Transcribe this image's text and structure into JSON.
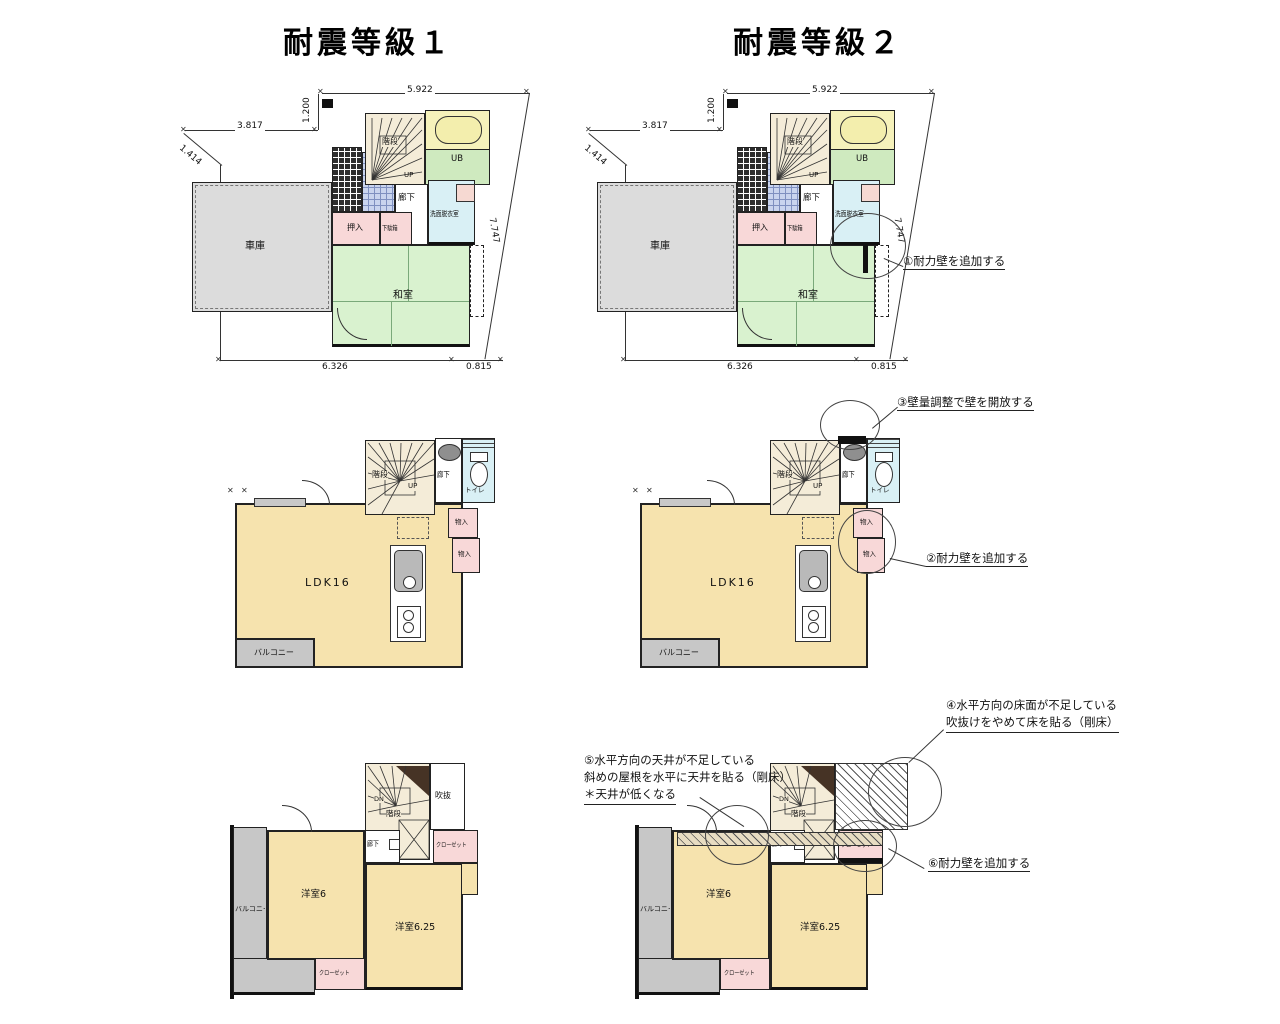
{
  "titles": {
    "grade1": "耐震等級１",
    "grade2": "耐震等級２"
  },
  "dimensions": {
    "top_width": "5.922",
    "entry_offset": "1.200",
    "left_top": "3.817",
    "diag_left": "1.414",
    "left_height": "5.364",
    "bottom_main": "6.326",
    "bottom_right": "0.815",
    "diag_right": "7.747"
  },
  "floor1": {
    "garage": "車庫",
    "oshiire": "押入",
    "getabako": "下駄箱",
    "stairs": "階段",
    "up": "UP",
    "hallway": "廊下",
    "washroom": "洗面脱衣室",
    "bath": "UB",
    "tatami": "和室"
  },
  "floor2": {
    "stairs": "階段",
    "up": "UP",
    "hallway": "廊下",
    "toilet": "トイレ",
    "storage_a": "物入",
    "storage_b": "物入",
    "ldk": "LDK16",
    "balcony": "バルコニー"
  },
  "floor3": {
    "stairs": "階段",
    "dn": "DN",
    "hallway": "廊下",
    "void": "吹抜",
    "closet_a": "クローゼット",
    "closet_b": "クローゼット",
    "bedroom_a": "洋室6",
    "bedroom_b": "洋室6.25",
    "balcony": "バルコニー"
  },
  "annotations": {
    "a1": "①耐力壁を追加する",
    "a2": "②耐力壁を追加する",
    "a3": "③壁量調整で壁を開放する",
    "a4_line1": "④水平方向の床面が不足している",
    "a4_line2": "吹抜けをやめて床を貼る（剛床）",
    "a5_line1": "⑤水平方向の天井が不足している",
    "a5_line2": "斜めの屋根を水平に天井を貼る（剛床）",
    "a5_line3": "＊天井が低くなる",
    "a6": "⑥耐力壁を追加する"
  },
  "colors": {
    "room_cream": "#f6e3ae",
    "tatami_green": "#d9f2cf",
    "bath_green": "#cfeabf",
    "bath_yellow": "#f6f2bb",
    "water_blue": "#d9f0f5",
    "closet_pink": "#f8d8d8",
    "garage_gray": "#dcdcdc",
    "balcony_gray": "#c7c7c7",
    "genkan_blue": "#c9d4ee",
    "wall_black": "#111111"
  }
}
